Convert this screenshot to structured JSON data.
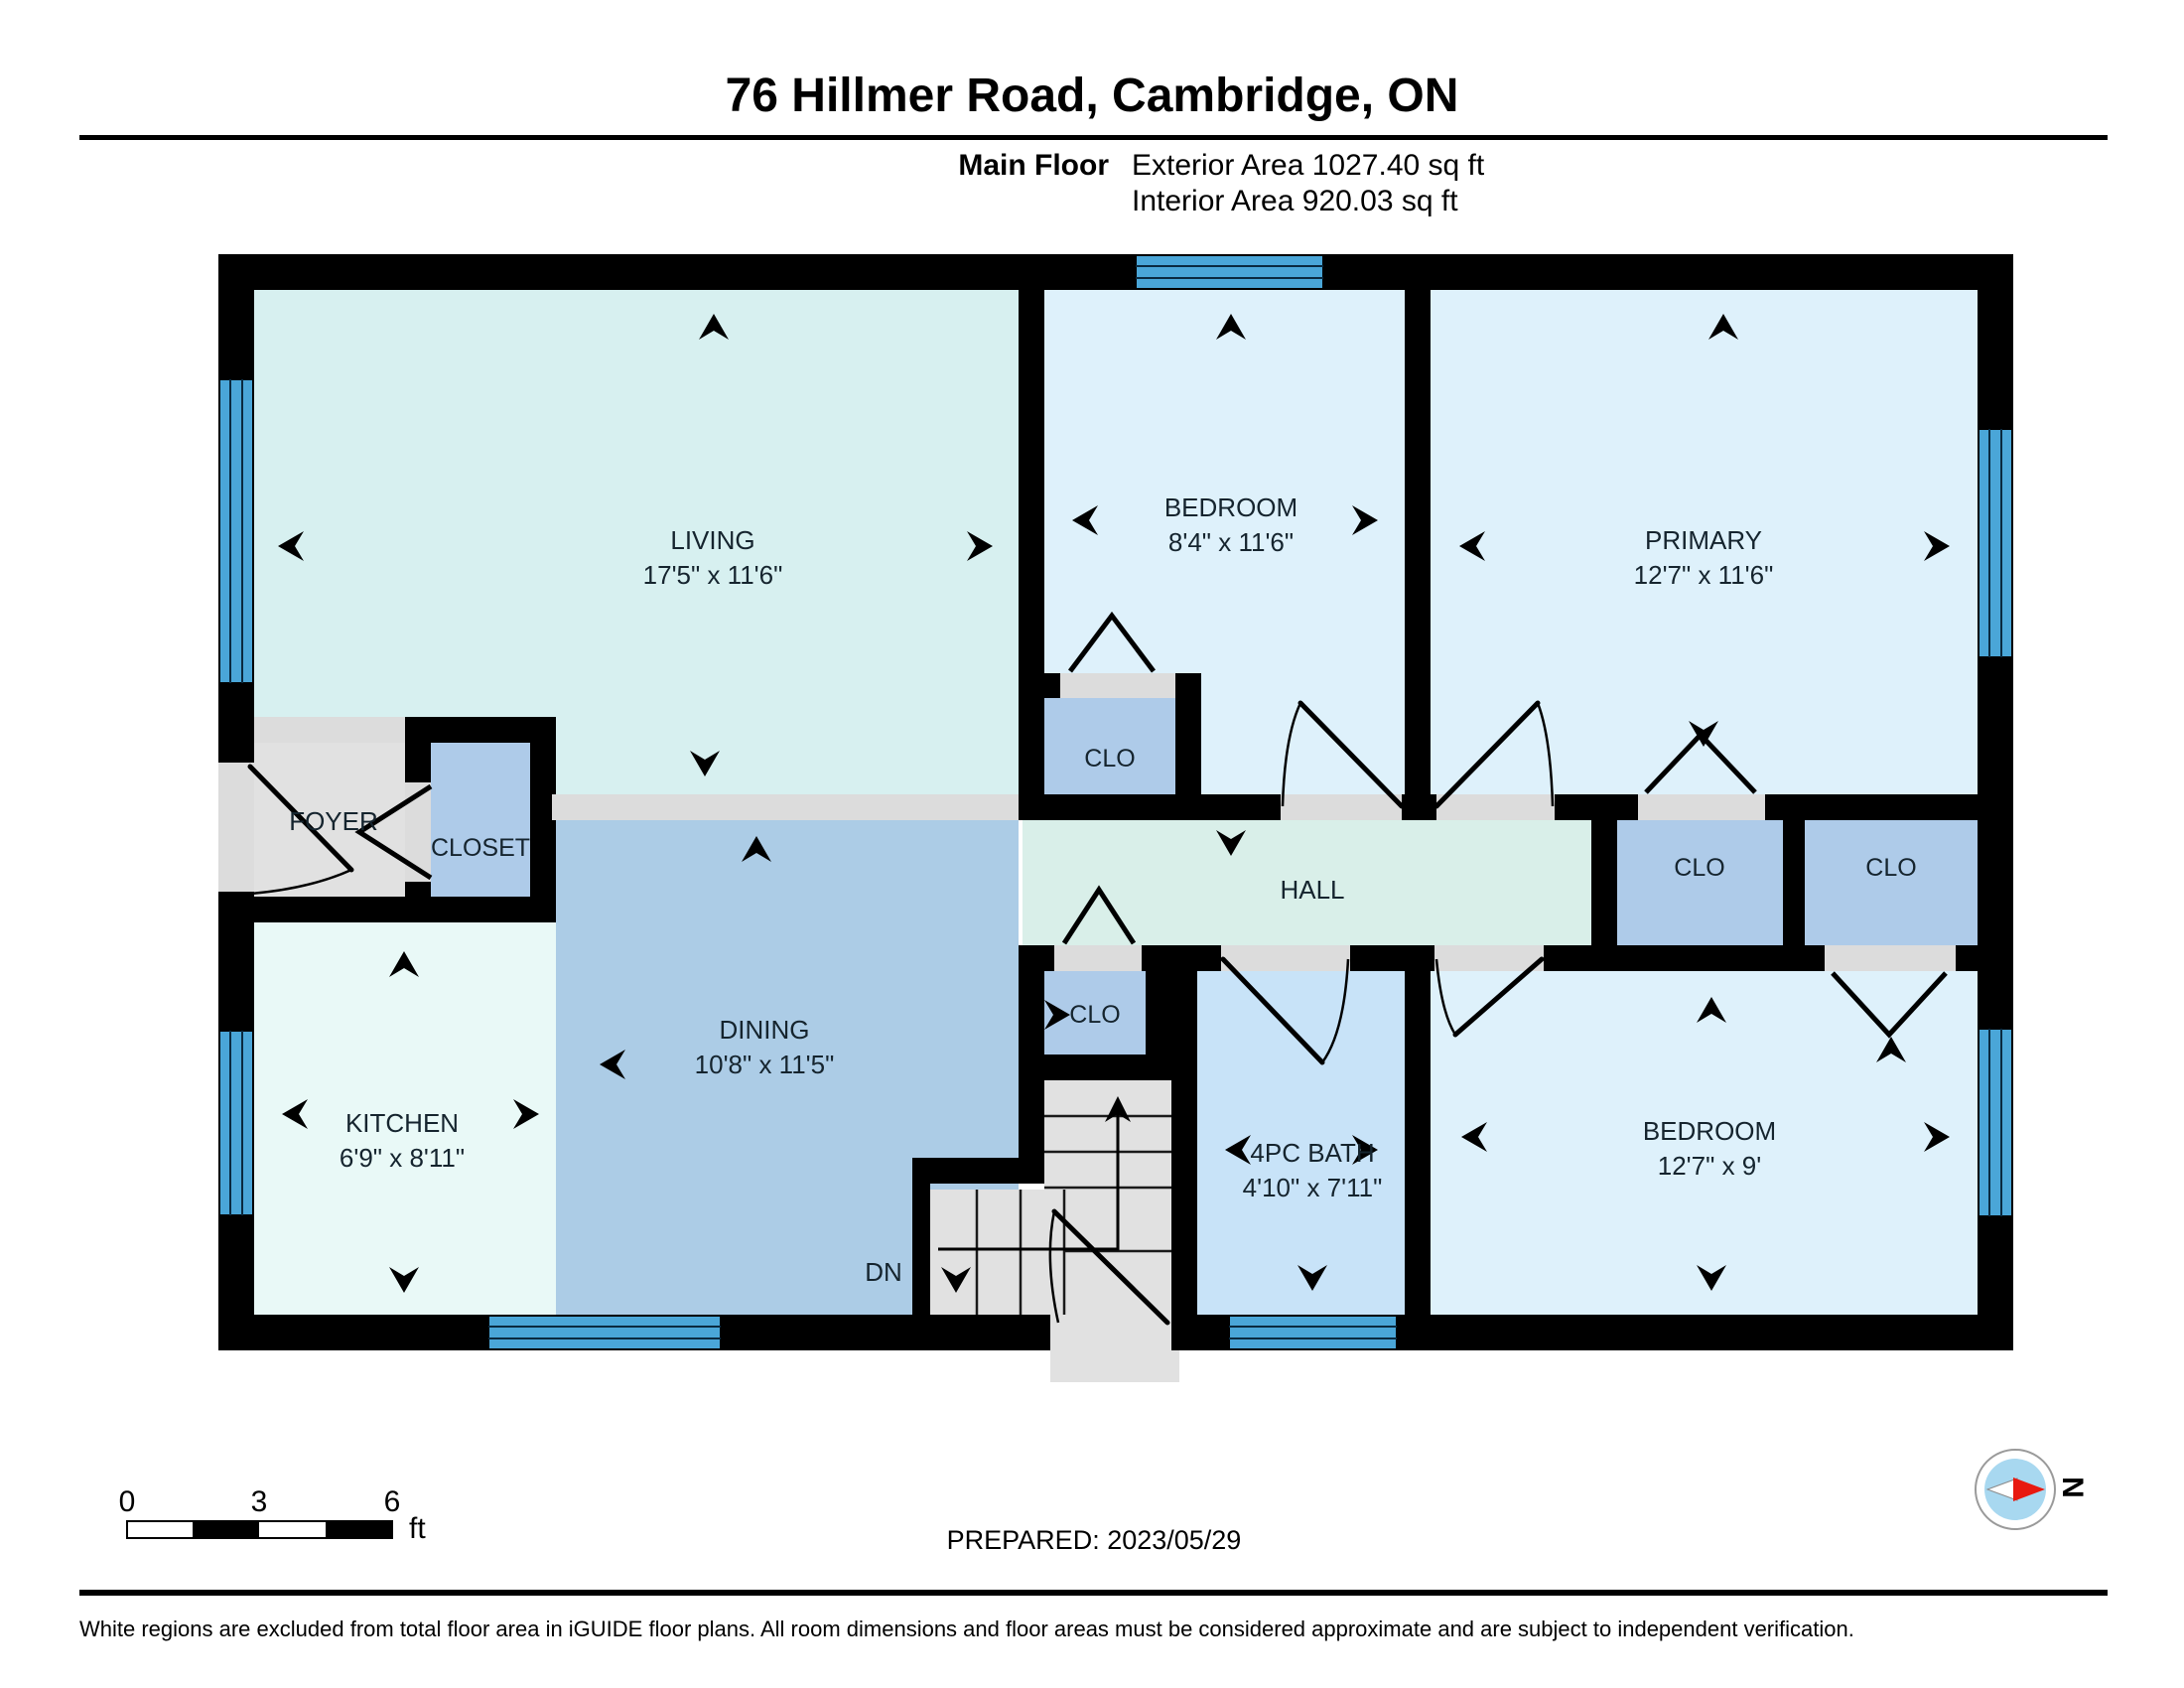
{
  "header": {
    "title": "76 Hillmer Road, Cambridge, ON",
    "floor_label": "Main Floor",
    "exterior_area": "Exterior Area 1027.40 sq ft",
    "interior_area": "Interior Area 920.03 sq ft"
  },
  "rooms": {
    "living": {
      "name": "LIVING",
      "dims": "17'5\" x 11'6\""
    },
    "bedroom": {
      "name": "BEDROOM",
      "dims": "8'4\" x 11'6\""
    },
    "primary": {
      "name": "PRIMARY",
      "dims": "12'7\" x 11'6\""
    },
    "foyer": {
      "name": "FOYER"
    },
    "closet": {
      "name": "CLOSET"
    },
    "bedroom_clo": {
      "name": "CLO"
    },
    "hall": {
      "name": "HALL"
    },
    "clo_primary": {
      "name": "CLO"
    },
    "clo_bedroom2": {
      "name": "CLO"
    },
    "stair_clo": {
      "name": "CLO"
    },
    "kitchen": {
      "name": "KITCHEN",
      "dims": "6'9\" x 8'11\""
    },
    "dining": {
      "name": "DINING",
      "dims": "10'8\" x 11'5\""
    },
    "stairs": {
      "label": "DN"
    },
    "bath": {
      "name": "4PC BATH",
      "dims": "4'10\" x 7'11\""
    },
    "bedroom2": {
      "name": "BEDROOM",
      "dims": "12'7\" x 9'"
    }
  },
  "scale_bar": {
    "tick0": "0",
    "tick3": "3",
    "tick6": "6",
    "unit": "ft"
  },
  "footer": {
    "prepared": "PREPARED: 2023/05/29",
    "disclaimer": "White regions are excluded from total floor area in iGUIDE floor plans. All room dimensions and floor areas must be considered approximate and are subject to independent verification.",
    "compass_label": "N"
  },
  "colors": {
    "wall": "#000000",
    "window_blue": "#4aa6d8",
    "living_fill": "#d7f0f0",
    "bedroom_fill": "#def1fb",
    "hall_fill": "#d9efe9",
    "kitchen_fill": "#e9f9f7",
    "dining_fill": "#accce6",
    "closet_fill": "#aecbe9",
    "bath_fill": "#c8e3f8",
    "gray_floor": "#e1e1e1",
    "compass_red": "#e8190f",
    "compass_blue": "#a8d8f0"
  }
}
